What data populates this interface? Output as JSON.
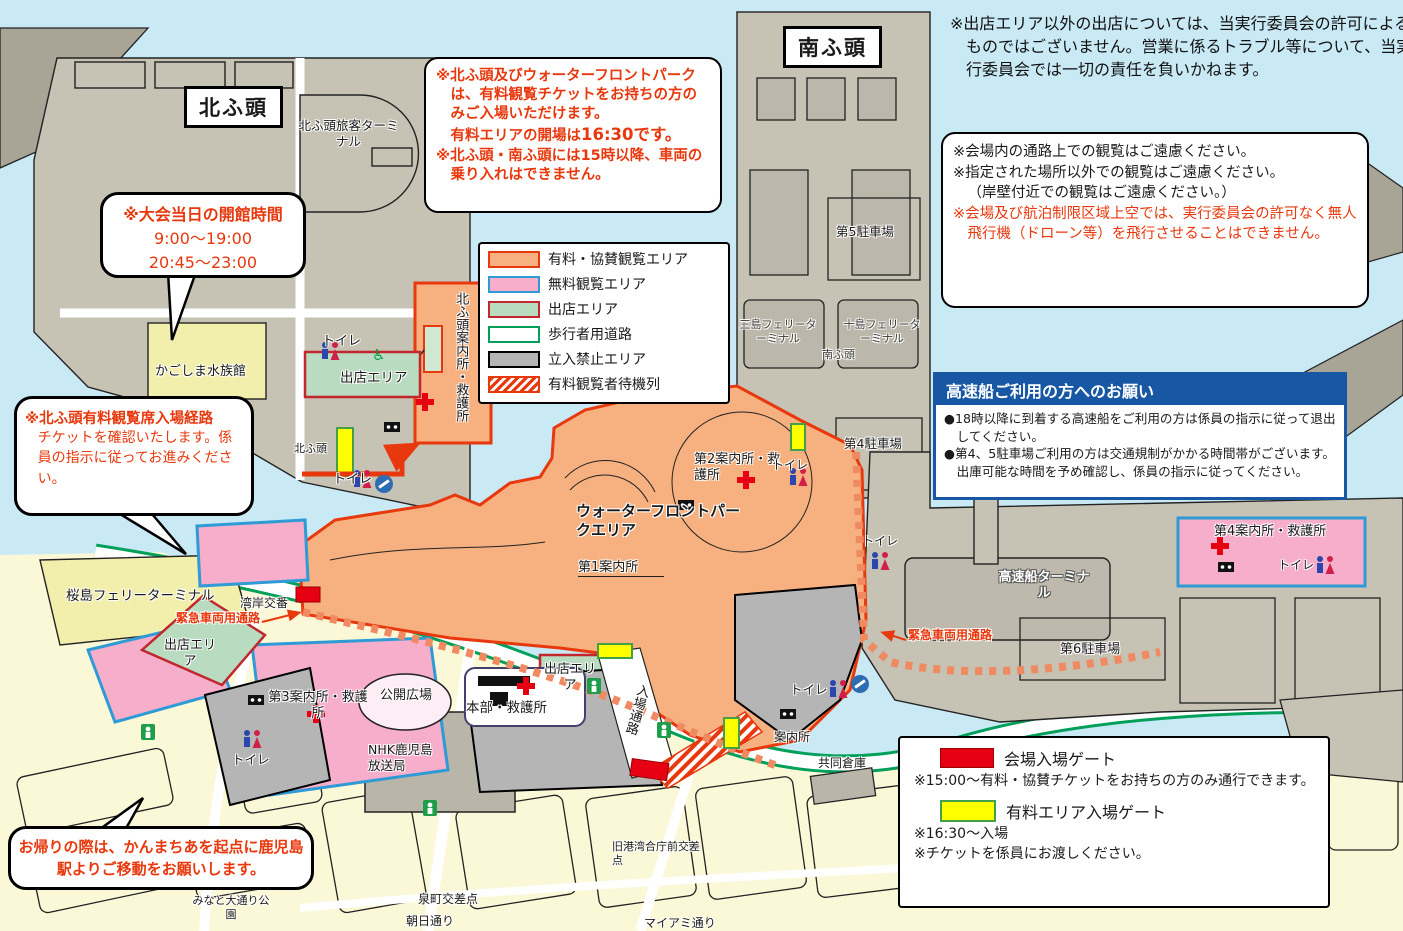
{
  "notices": {
    "stalls_disclaimer": "※出店エリア以外の出店については、当実行委員会の許可によるものではございません。営業に係るトラブル等について、当実行委員会では一切の責任を負いかねます。",
    "ticket": {
      "p1": "※北ふ頭及びウォーターフロントパークは、有料観覧チケットをお持ちの方のみご入場いただけます。",
      "p2_pre": "有料エリアの開場は",
      "p2_bold": "16:30です。",
      "p3": "※北ふ頭・南ふ頭には15時以降、車両の乗り入れはできません。"
    },
    "viewing": {
      "l1": "※会場内の通路上での観覧はご遠慮ください。",
      "l2": "※指定された場所以外での観覧はご遠慮ください。",
      "l3": "（岸壁付近での観覧はご遠慮ください。）",
      "l4_red": "※会場及び航泊制限区域上空では、実行委員会の許可なく無人飛行機（ドローン等）を飛行させることはできません。"
    },
    "speedboat": {
      "title": "高速船ご利用の方へのお願い",
      "b1": "●18時以降に到着する高速船をご利用の方は係員の指示に従って退出してください。",
      "b2": "●第4、5駐車場ご利用の方は交通規制がかかる時間帯がございます。出庫可能な時間を予め確認し、係員の指示に従ってください。"
    }
  },
  "bubbles": {
    "aquarium_hours": {
      "title": "※大会当日の開館時間",
      "time1": "9:00〜19:00",
      "time2": "20:45〜23:00"
    },
    "north_entry": {
      "title": "※北ふ頭有料観覧席入場経路",
      "body": "チケットを確認いたします。係員の指示に従ってお進みください。"
    },
    "return_route": "お帰りの際は、かんまちあを起点に鹿児島駅よりご移動をお願いします。"
  },
  "legend": {
    "items": [
      {
        "label": "有料・協賛観覧エリア",
        "fill": "#f7b07f",
        "border": "#e8380d"
      },
      {
        "label": "無料観覧エリア",
        "fill": "#f6aecb",
        "border": "#2e9bd6"
      },
      {
        "label": "出店エリア",
        "fill": "#b9dcc1",
        "border": "#c1272d"
      },
      {
        "label": "歩行者用道路",
        "fill": "#ffffff",
        "border": "#00a05a"
      },
      {
        "label": "立入禁止エリア",
        "fill": "#b5b5b5",
        "border": "#000000"
      },
      {
        "label": "有料観覧者待機列",
        "fill": "hatch-red",
        "border": "#e8380d"
      }
    ]
  },
  "gates": {
    "venue_gate_label": "会場入場ゲート",
    "venue_gate_note": "※15:00〜有料・協賛チケットをお持ちの方のみ通行できます。",
    "paid_gate_label": "有料エリア入場ゲート",
    "paid_gate_note1": "※16:30〜入場",
    "paid_gate_note2": "※チケットを係員にお渡しください。",
    "venue_gate_color": "#e60012",
    "paid_gate_color": "#ffff00"
  },
  "map_labels": {
    "kita_futo": "北ふ頭",
    "minami_futo": "南ふ頭",
    "kita_terminal": "北ふ頭旅客ターミナル",
    "aquarium": "かごしま水族館",
    "toilet": "トイレ",
    "stall_area": "出店エリア",
    "kita_info": "北ふ頭案内所・救護所",
    "sakurajima_ferry": "桜島フェリーターミナル",
    "wangan_koban": "湾岸交番",
    "emergency_route": "緊急車両用通路",
    "info3": "第3案内所・救護所",
    "open_plaza": "公開広場",
    "nhk": "NHK鹿児島放送局",
    "hq": "本部・救護所",
    "entry_path": "入場通路",
    "info_booth": "案内所",
    "kyodo_soko": "共同倉庫",
    "old_port_crossing": "旧港湾合庁前交差点",
    "miami_street": "マイアミ通り",
    "asahi_street": "朝日通り",
    "izumicho_crossing": "泉町交差点",
    "minato_park": "みなと大通り公園",
    "waterfront_park": "ウォーターフロントパークエリア",
    "info1": "第1案内所",
    "info2": "第2案内所・救護所",
    "mishima_ferry": "三島フェリーターミナル",
    "toshima_ferry": "十島フェリーターミナル",
    "parking5": "第5駐車場",
    "parking4": "第4駐車場",
    "parking6": "第6駐車場",
    "speedboat_terminal": "高速船ターミナル",
    "info4": "第4案内所・救護所"
  }
}
